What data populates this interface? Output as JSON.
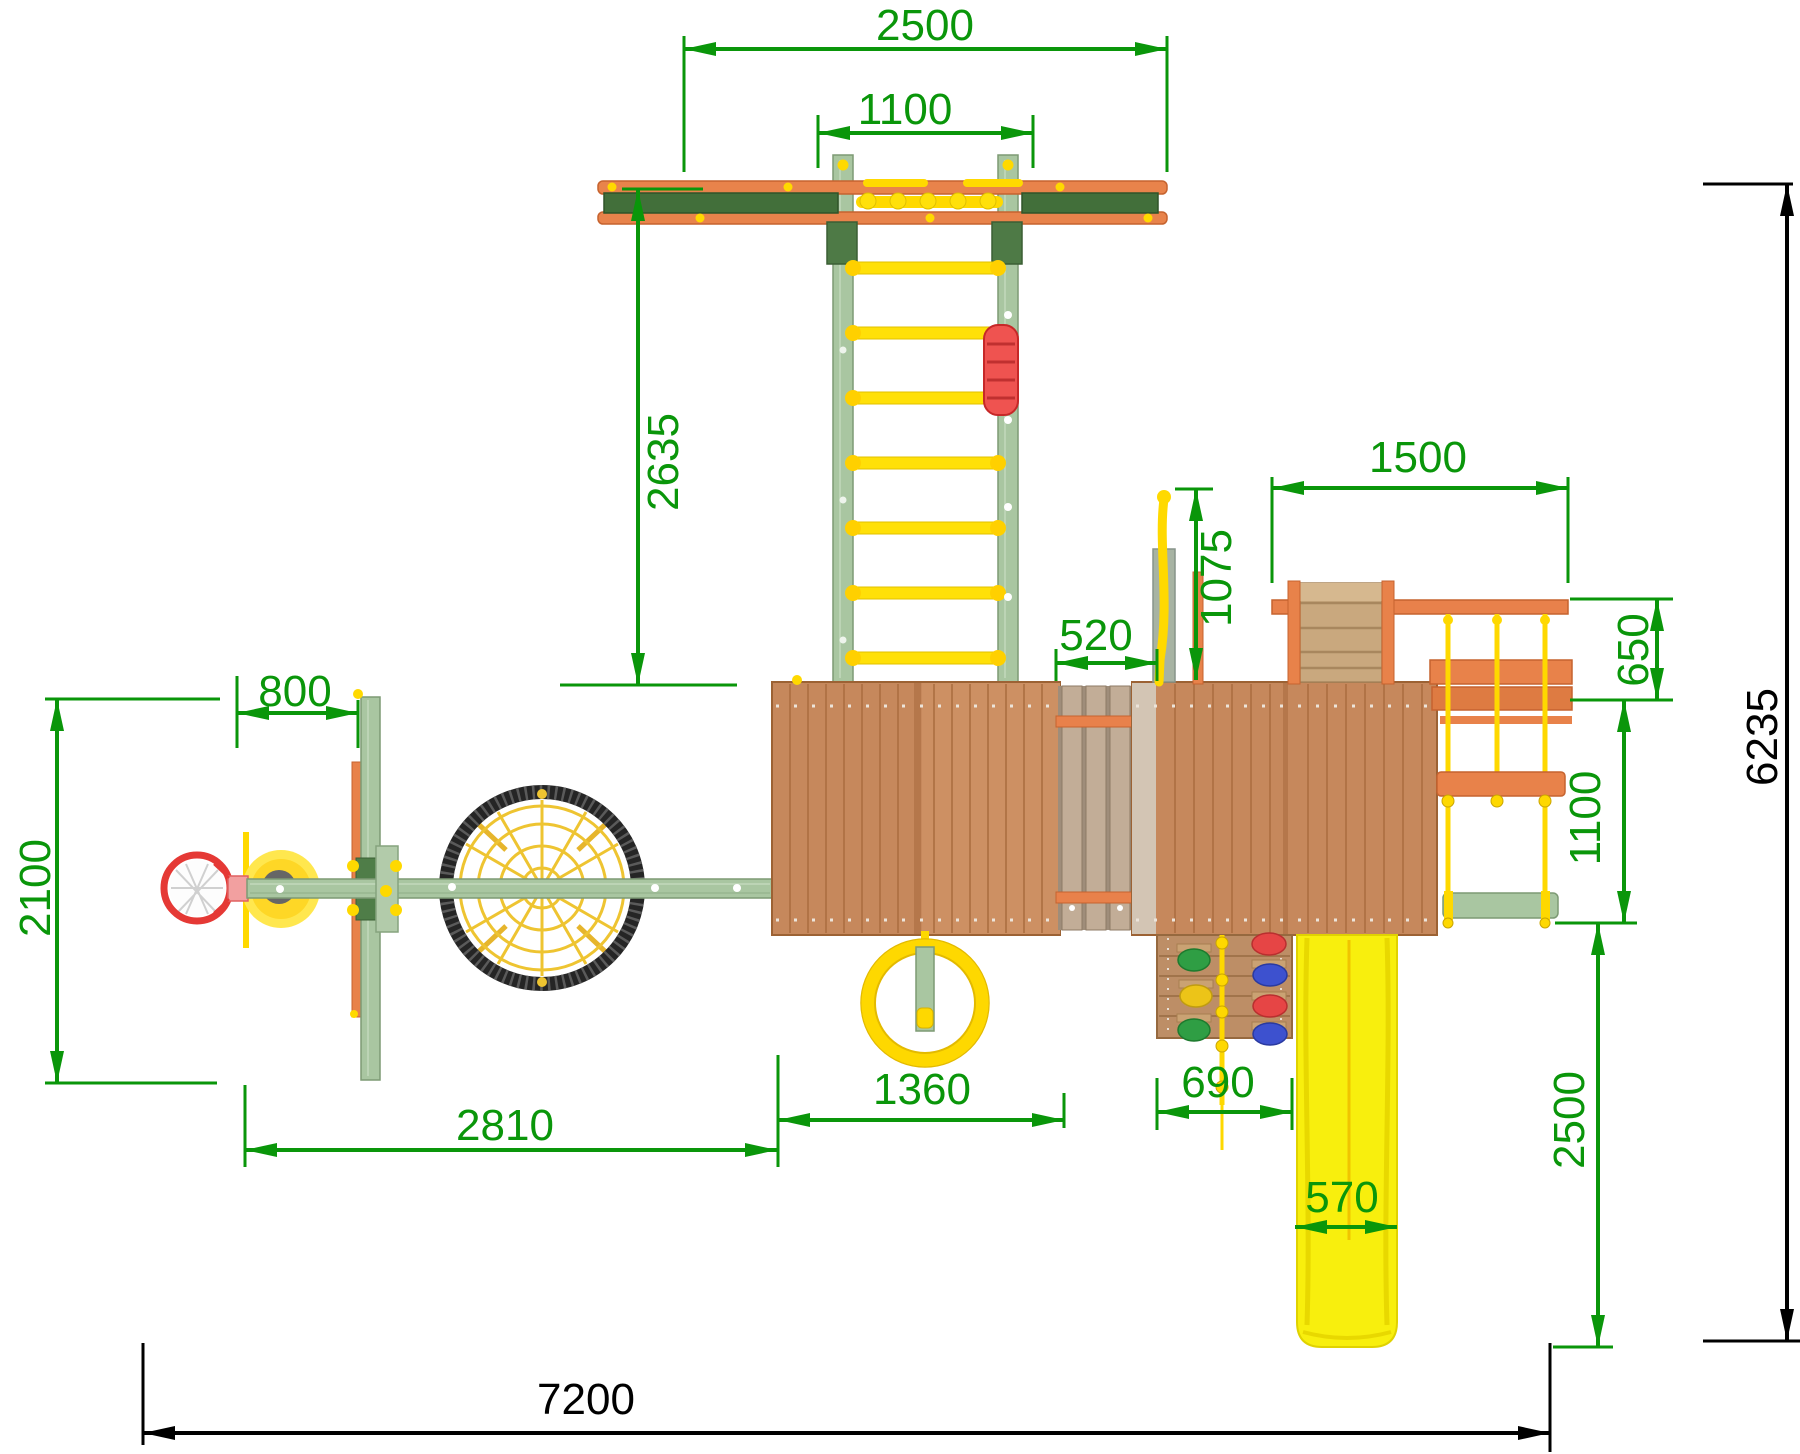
{
  "drawing": {
    "type": "playground-equipment-plan-top-view",
    "units": "mm",
    "dim_color": "#0a960a",
    "overall_dim_color": "#000000",
    "dims": {
      "swing_beam_span": "2500",
      "ladder_rail_spacing": "1100",
      "ladder_length": "2635",
      "right_module_span": "1500",
      "firemans_pole_offset": "1075",
      "tower_gap": "520",
      "rope_ladder_depth": "650",
      "swing_seat_drop": "1100",
      "slide_length": "2500",
      "backboard_offset": "800",
      "basketball_beam_reach": "2100",
      "swing_arm_span": "2810",
      "central_tower_width": "1360",
      "climbing_wall_width": "690",
      "slide_width": "570",
      "overall_length": "7200",
      "overall_depth": "6235"
    }
  }
}
